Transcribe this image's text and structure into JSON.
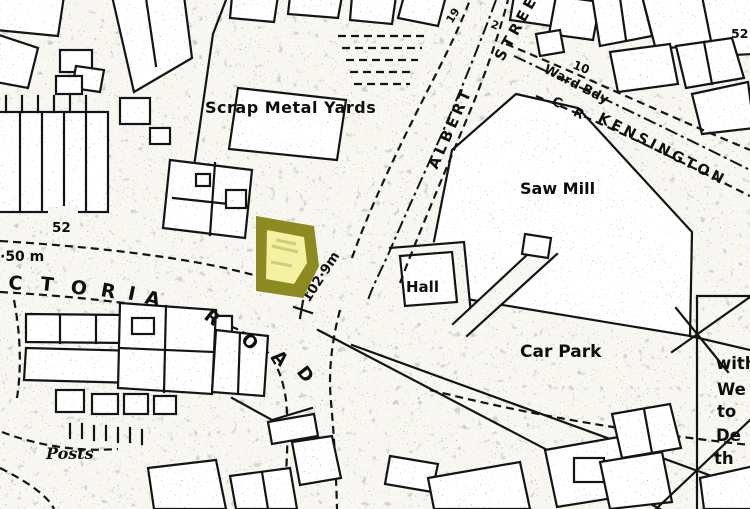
{
  "map": {
    "description": "Scanned monochrome street map extract with one building highlighted in yellow",
    "colors": {
      "paper": "#f8f7f2",
      "ink": "#141414",
      "highlight_outer": "#8e8a22",
      "highlight_inner": "#f4f1a3"
    },
    "labels": {
      "scrap_metal_yards": "Scrap Metal Yards",
      "albert": "ALBERT",
      "street": "STREET",
      "ward_bdy": "Ward Bdy",
      "c_r": "C R",
      "kensington": "KENSINGTON",
      "saw_mill": "Saw Mill",
      "hall": "Hall",
      "car_park": "Car Park",
      "posts": "Posts",
      "spot_height_junction": "102·9m",
      "spot_height_left": "·50 m",
      "house_number_52": "52",
      "house_number_19": "19",
      "house_number_10": "10",
      "house_number_2": "2",
      "house_number_52_right": "52"
    },
    "victoria_letters": [
      "C",
      "T",
      "O",
      "R",
      "I",
      "A"
    ],
    "road_letters": [
      "R",
      "O",
      "A",
      "D"
    ],
    "edge_note_fragments": [
      "with",
      "We",
      "to",
      "De",
      "th"
    ]
  }
}
